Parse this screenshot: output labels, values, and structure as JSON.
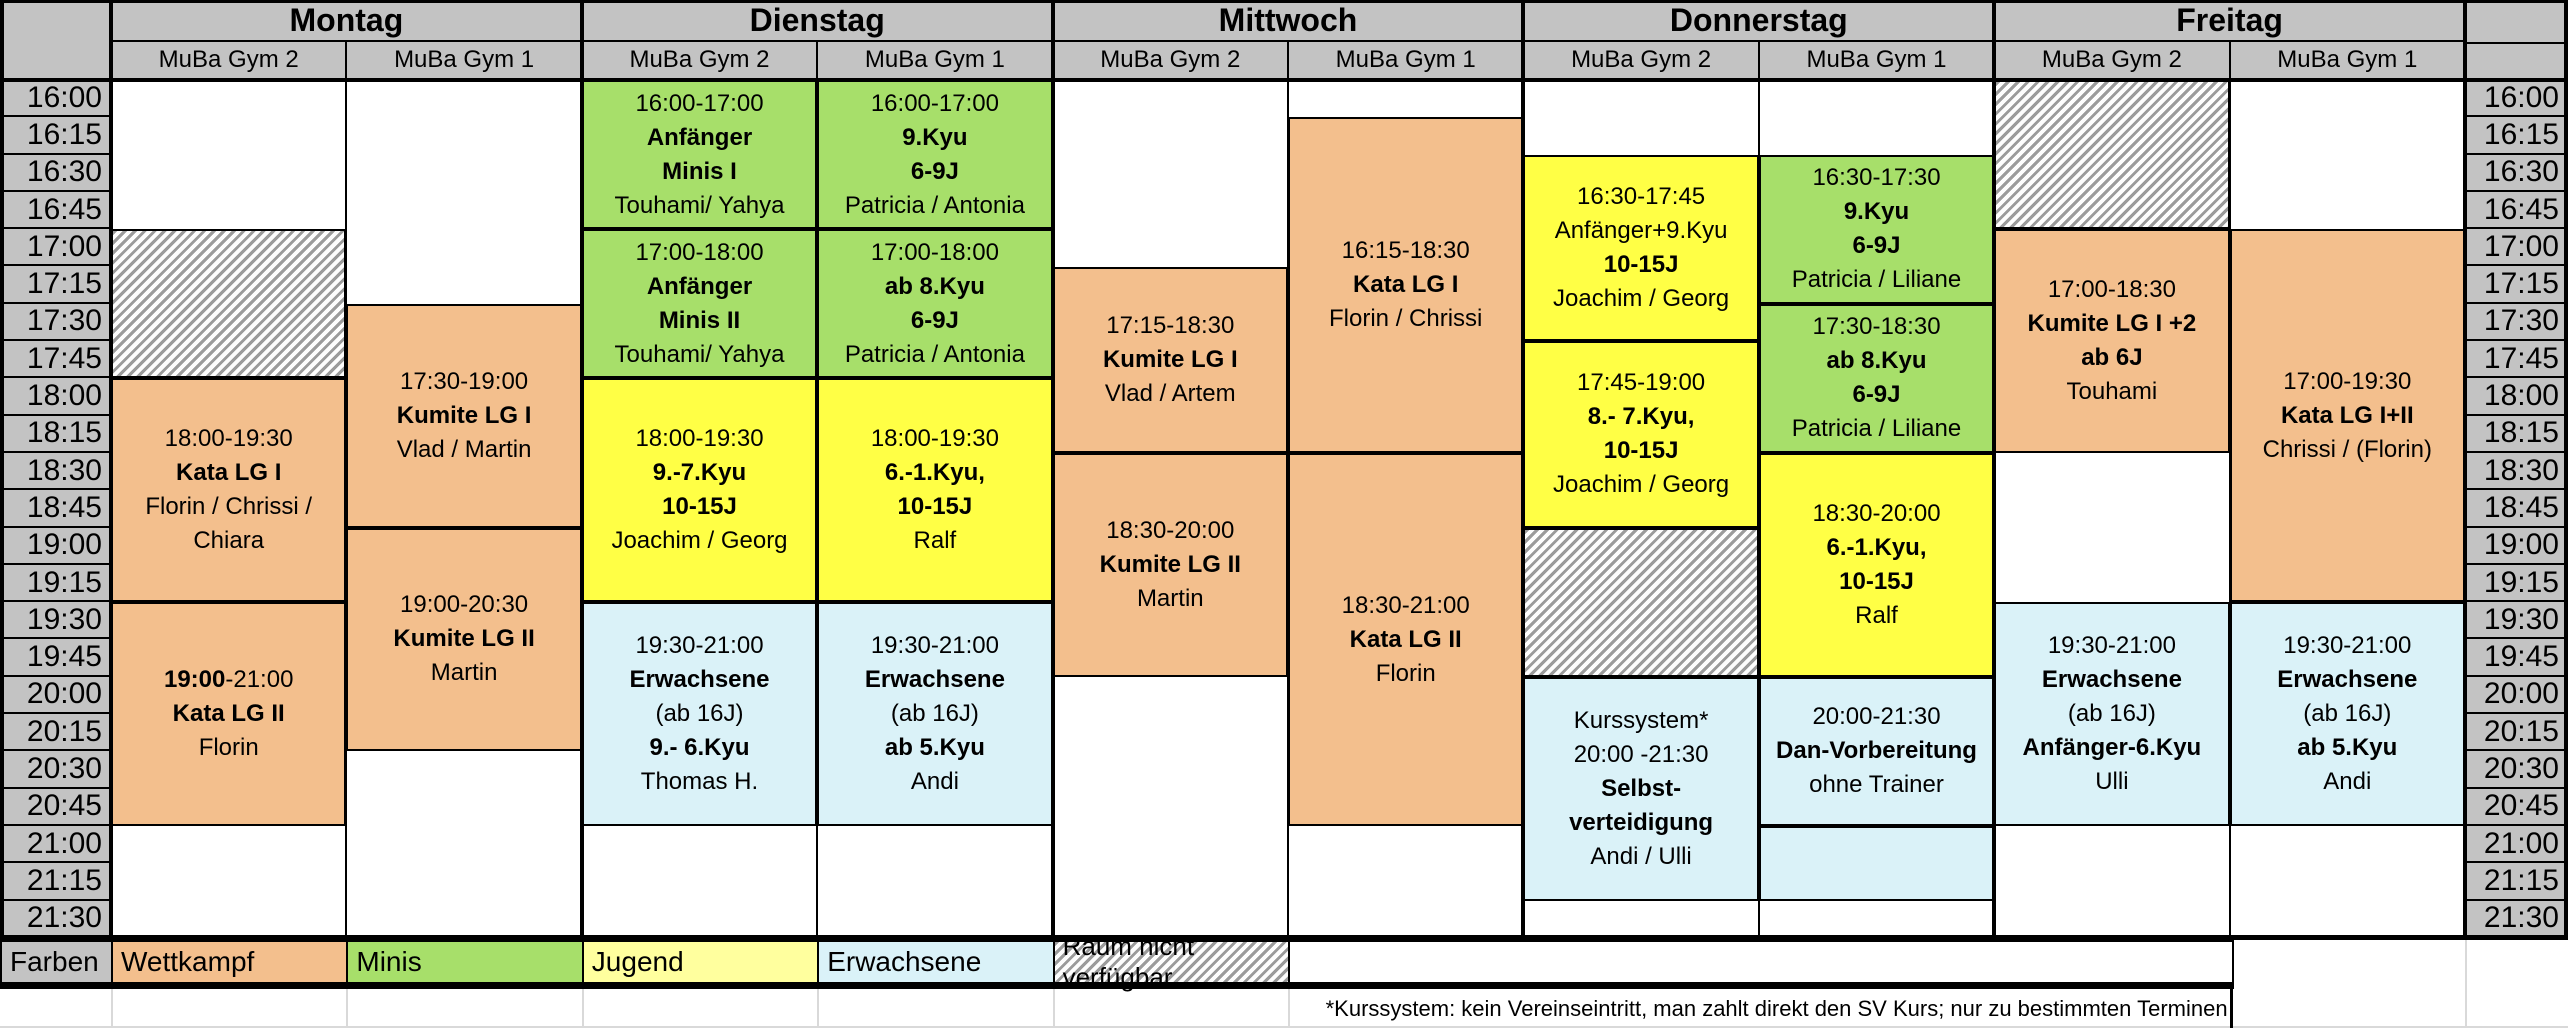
{
  "days": [
    {
      "name": "Montag",
      "gym2": "MuBa Gym 2",
      "gym1": "MuBa Gym 1"
    },
    {
      "name": "Dienstag",
      "gym2": "MuBa Gym 2",
      "gym1": "MuBa Gym 1"
    },
    {
      "name": "Mittwoch",
      "gym2": "MuBa Gym 2",
      "gym1": "MuBa Gym 1"
    },
    {
      "name": "Donnerstag",
      "gym2": "MuBa Gym 2",
      "gym1": "MuBa Gym 1"
    },
    {
      "name": "Freitag",
      "gym2": "MuBa Gym 2",
      "gym1": "MuBa Gym 1"
    }
  ],
  "times": [
    "16:00",
    "16:15",
    "16:30",
    "16:45",
    "17:00",
    "17:15",
    "17:30",
    "17:45",
    "18:00",
    "18:15",
    "18:30",
    "18:45",
    "19:00",
    "19:15",
    "19:30",
    "19:45",
    "20:00",
    "20:15",
    "20:30",
    "20:45",
    "21:00",
    "21:15",
    "21:30"
  ],
  "events": {
    "mon2_kata1": {
      "lines": [
        "18:00-19:30",
        "Kata LG I",
        "Florin / Chrissi /",
        "Chiara"
      ]
    },
    "mon2_kata2": {
      "time_bold": "19:00",
      "time_rest": "-21:00",
      "title": "Kata LG II",
      "trainer": "Florin"
    },
    "mon1_kumite1": {
      "lines": [
        "17:30-19:00",
        "Kumite LG I",
        "Vlad / Martin"
      ]
    },
    "mon1_kumite2": {
      "lines": [
        "19:00-20:30",
        "Kumite LG II",
        "Martin"
      ]
    },
    "tue2_minis1": {
      "lines": [
        "16:00-17:00",
        "Anfänger",
        "Minis I",
        "Touhami/ Yahya"
      ]
    },
    "tue2_minis2": {
      "lines": [
        "17:00-18:00",
        "Anfänger",
        "Minis II",
        "Touhami/ Yahya"
      ]
    },
    "tue2_jugend": {
      "lines": [
        "18:00-19:30",
        "9.-7.Kyu",
        "10-15J",
        "Joachim / Georg"
      ]
    },
    "tue2_erw": {
      "lines": [
        "19:30-21:00",
        "Erwachsene",
        "(ab 16J)",
        "9.- 6.Kyu",
        "Thomas H."
      ]
    },
    "tue1_kyu9": {
      "lines": [
        "16:00-17:00",
        "9.Kyu",
        "6-9J",
        "Patricia / Antonia"
      ]
    },
    "tue1_kyu8": {
      "lines": [
        "17:00-18:00",
        "ab 8.Kyu",
        "6-9J",
        "Patricia / Antonia"
      ]
    },
    "tue1_jugend": {
      "lines": [
        "18:00-19:30",
        "6.-1.Kyu,",
        "10-15J",
        "Ralf"
      ]
    },
    "tue1_erw": {
      "lines": [
        "19:30-21:00",
        "Erwachsene",
        "(ab 16J)",
        "ab 5.Kyu",
        "Andi"
      ]
    },
    "wed2_kumite1": {
      "lines": [
        "17:15-18:30",
        "Kumite LG I",
        "Vlad / Artem"
      ]
    },
    "wed2_kumite2": {
      "lines": [
        "18:30-20:00",
        "Kumite LG II",
        "Martin"
      ]
    },
    "wed1_kata1": {
      "lines": [
        "16:15-18:30",
        "Kata LG I",
        "Florin / Chrissi"
      ]
    },
    "wed1_kata2": {
      "lines": [
        "18:30-21:00",
        "Kata LG II",
        "Florin"
      ]
    },
    "thu2_jugend1": {
      "lines": [
        "16:30-17:45",
        "Anfänger+9.Kyu",
        "10-15J",
        "Joachim / Georg"
      ]
    },
    "thu2_jugend2": {
      "lines": [
        "17:45-19:00",
        "8.- 7.Kyu,",
        "10-15J",
        "Joachim / Georg"
      ]
    },
    "thu2_kurs": {
      "lines": [
        "Kurssystem*",
        "20:00 -21:30",
        "Selbst-",
        "verteidigung",
        "Andi / Ulli"
      ]
    },
    "thu1_kyu9": {
      "lines": [
        "16:30-17:30",
        "9.Kyu",
        "6-9J",
        "Patricia / Liliane"
      ]
    },
    "thu1_kyu8": {
      "lines": [
        "17:30-18:30",
        "ab 8.Kyu",
        "6-9J",
        "Patricia / Liliane"
      ]
    },
    "thu1_jugend": {
      "lines": [
        "18:30-20:00",
        "6.-1.Kyu,",
        "10-15J",
        "Ralf"
      ]
    },
    "thu1_dan": {
      "lines": [
        "20:00-21:30",
        "Dan-Vorbereitung",
        "ohne Trainer"
      ]
    },
    "fri2_kumite": {
      "lines": [
        "17:00-18:30",
        "Kumite LG I +2",
        "ab 6J",
        "Touhami"
      ]
    },
    "fri2_erw": {
      "lines": [
        "19:30-21:00",
        "Erwachsene",
        "(ab 16J)",
        "Anfänger-6.Kyu",
        "Ulli"
      ]
    },
    "fri1_kata": {
      "lines": [
        "17:00-19:30",
        "Kata LG I+II",
        "Chrissi / (Florin)"
      ]
    },
    "fri1_erw": {
      "lines": [
        "19:30-21:00",
        "Erwachsene",
        "(ab 16J)",
        "ab 5.Kyu",
        "Andi"
      ]
    }
  },
  "legend": {
    "label": "Farben",
    "wettkampf": "Wettkampf",
    "minis": "Minis",
    "jugend": "Jugend",
    "erwachsene": "Erwachsene",
    "unavailable": "Raum nicht verfügbar"
  },
  "footnote": "*Kurssystem: kein Vereinseintritt, man zahlt direkt den SV Kurs; nur zu bestimmten Terminen",
  "colors": {
    "wettkampf": "#F3BF8D",
    "minis": "#A7DF6A",
    "jugend": "#FFFF45",
    "jugend_legend": "#FFFF9E",
    "erwachsene": "#DAF2F8",
    "header_gray": "#C3C3C3",
    "hatch_gray": "#9B9B9B"
  }
}
